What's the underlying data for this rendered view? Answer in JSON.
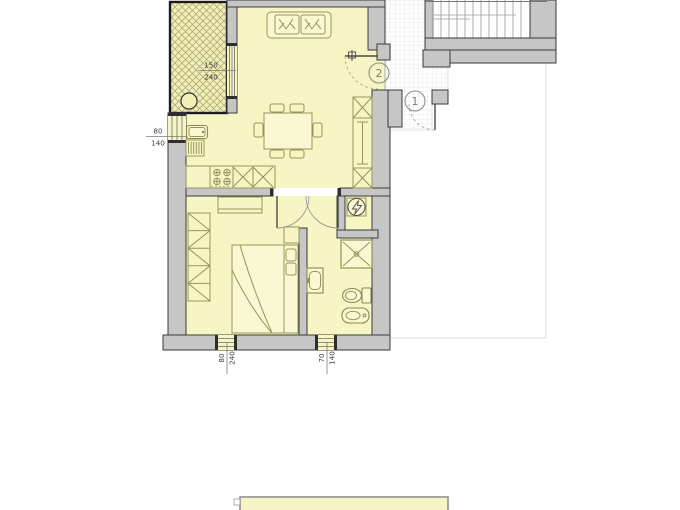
{
  "title": "apartment-floor-plan",
  "colors": {
    "floor": "#f7f5c4",
    "wall_fill": "#c6c6c6",
    "wall_stroke": "#3a3a3a",
    "balcony_border": "#1c1c1c",
    "hatch_line": "#b2ac7c",
    "furniture_stroke": "#97965a",
    "landing_grid": "#e4e4e4",
    "dimension_text": "#3f3f3f",
    "marker_stroke": "#8f8f8f"
  },
  "dimensions": {
    "balcony_door": {
      "width": "150",
      "height": "240"
    },
    "kitchen_window": {
      "width": "80",
      "height": "140"
    },
    "bedroom_window": {
      "width": "80",
      "height": "240"
    },
    "bathroom_window": {
      "width": "70",
      "height": "140"
    }
  },
  "door_markers": {
    "stair_landing": "1",
    "entry": "2"
  }
}
